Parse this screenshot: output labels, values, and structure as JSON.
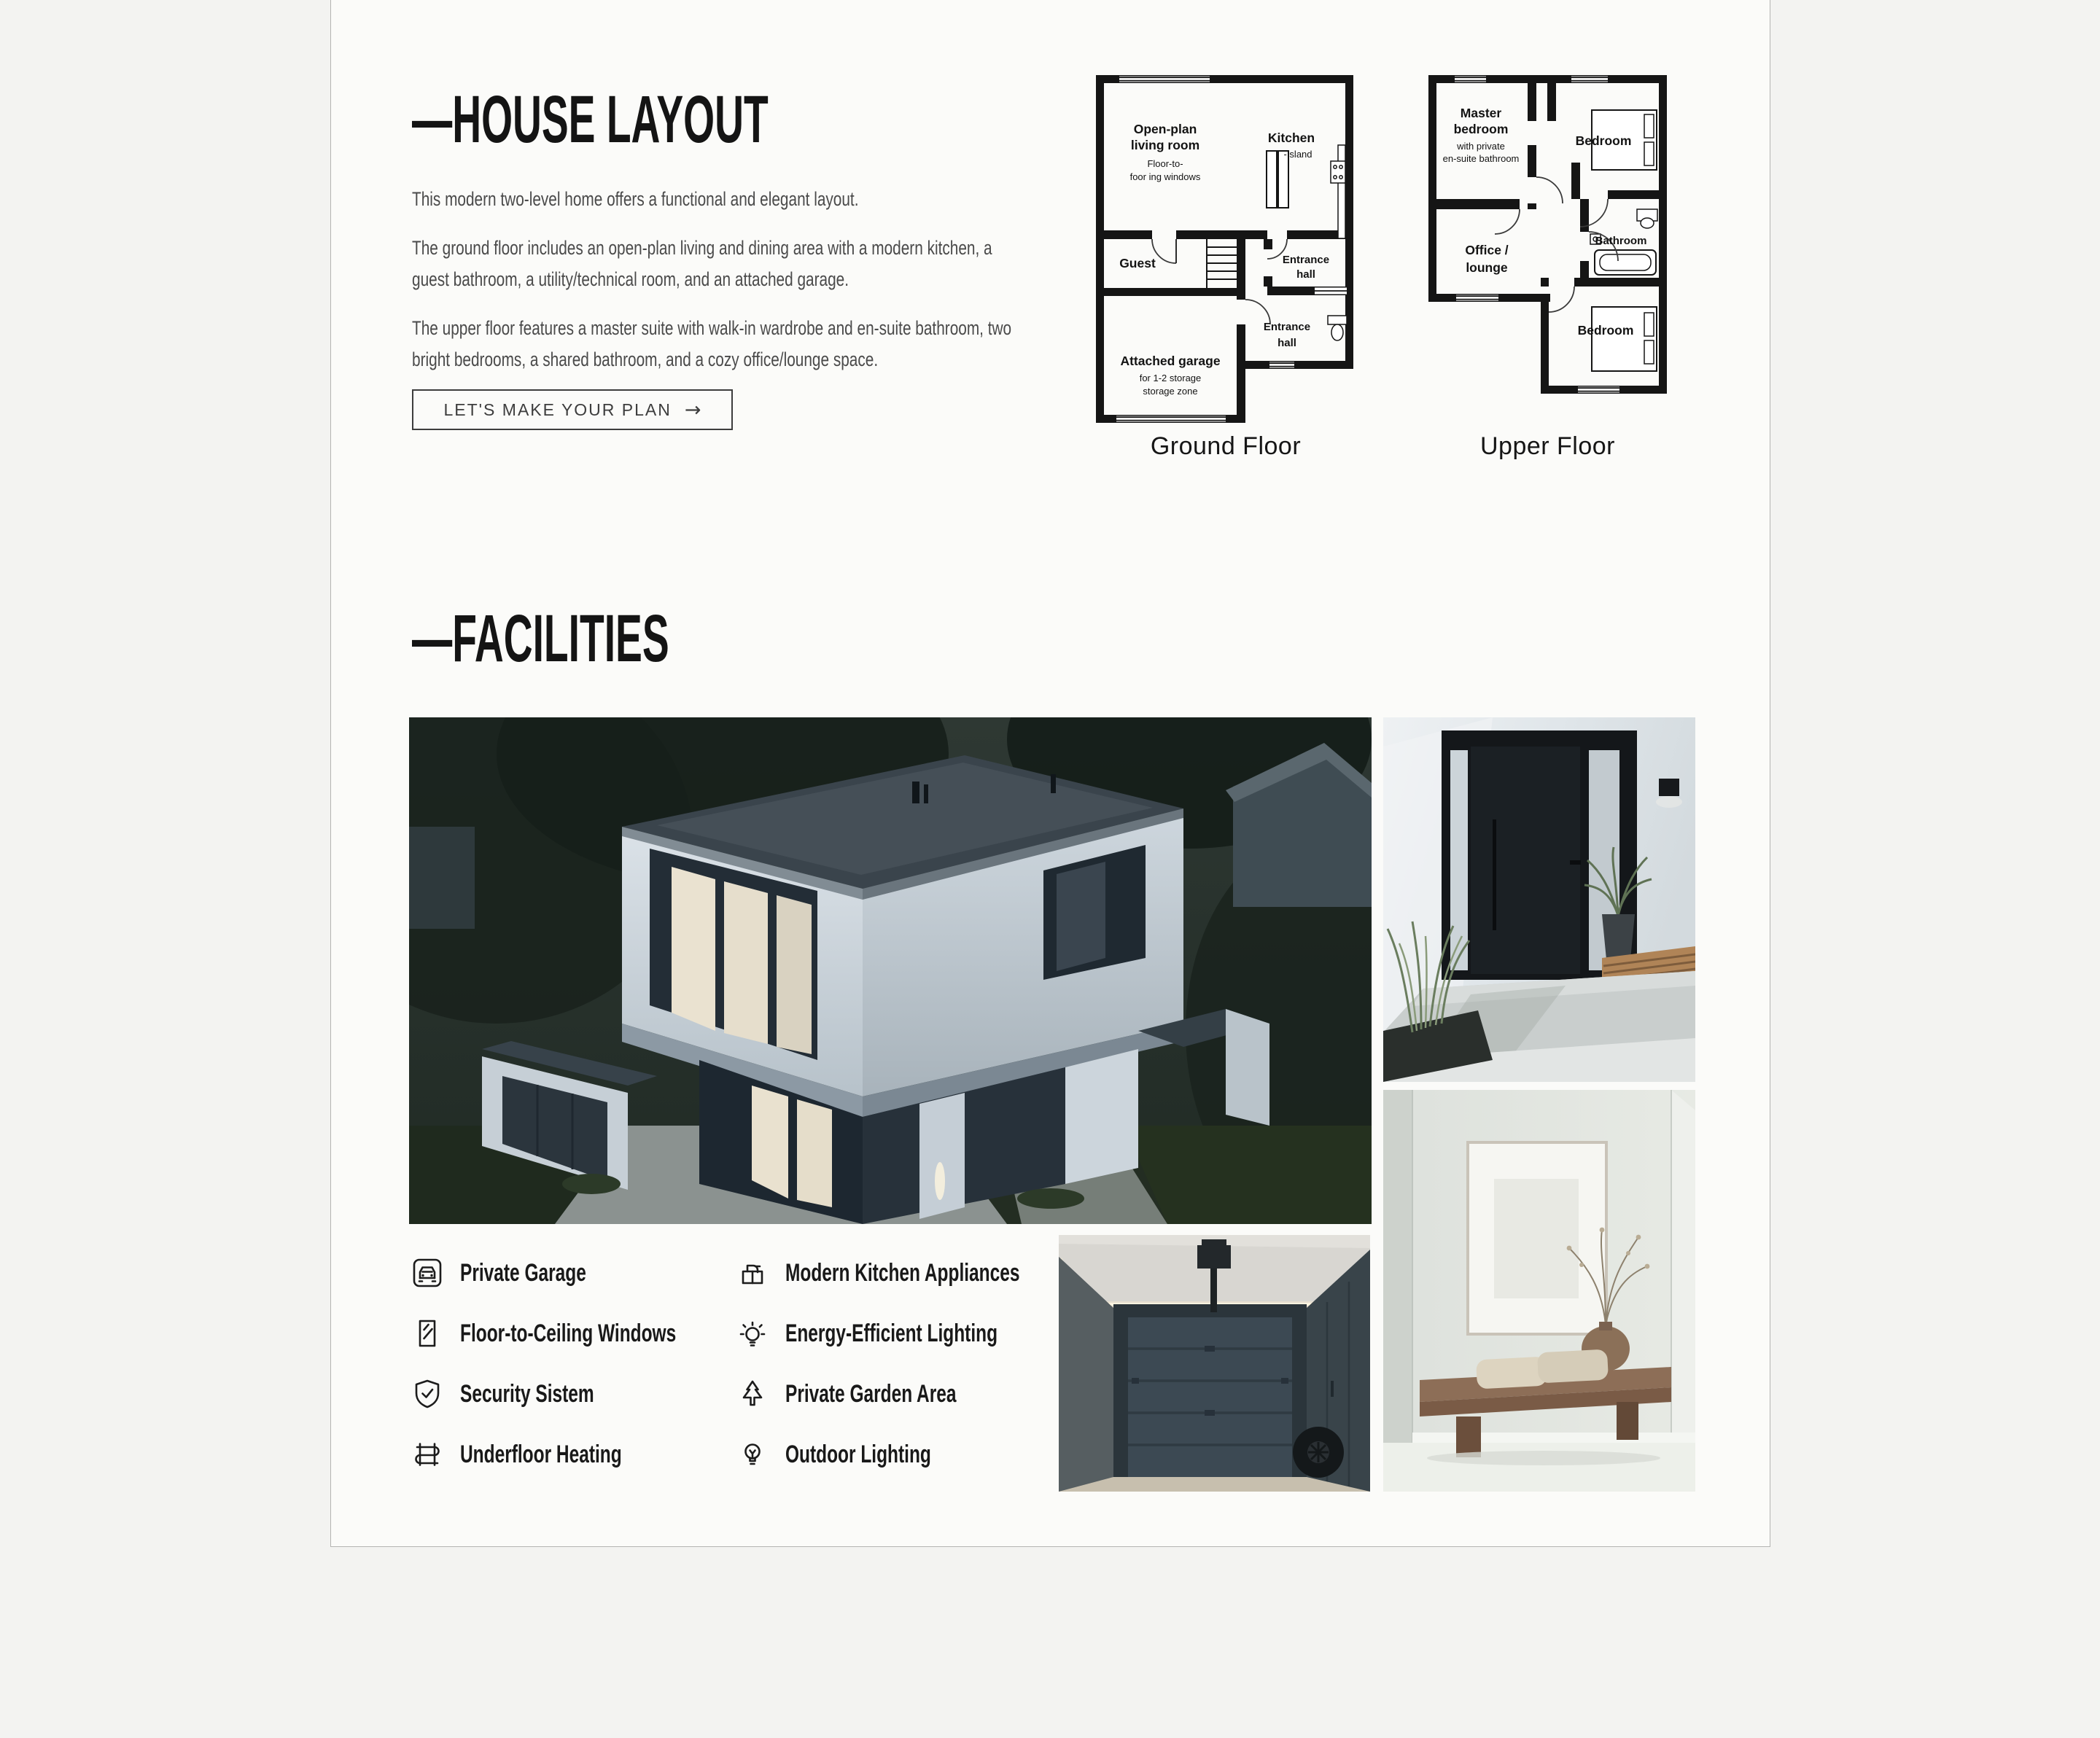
{
  "theme": {
    "page_bg": "#f3f3f1",
    "card_bg": "#fbfbf9",
    "card_border": "#b4b4b2",
    "heading_color": "#141414",
    "body_text_color": "#4a4a4a",
    "accent_dark": "#3d3d3d",
    "plan_ink": "#151515"
  },
  "layout_section": {
    "heading": "—HOUSE LAYOUT",
    "paragraphs": [
      "This modern two-level home offers a functional and elegant layout.",
      "The ground floor includes an open-plan living and dining area with a modern kitchen, a guest bathroom, a utility/technical room, and an attached garage.",
      "The upper floor features a master suite with walk-in wardrobe and en-suite bathroom, two bright bedrooms, a shared bathroom, and a cozy office/lounge space."
    ],
    "cta": {
      "label": "LET'S MAKE YOUR PLAN",
      "arrow": "→"
    }
  },
  "floor_plans": {
    "ground": {
      "caption": "Ground Floor",
      "living1": "Open-plan",
      "living2": "living room",
      "living3": "Floor-to-",
      "living4": "foor ing windows",
      "kitchen": "Kitchen",
      "island": "-Island",
      "guest": "Guest",
      "hallA1": "Entrance",
      "hallA2": "hall",
      "hallB1": "Entrance",
      "hallB2": "hall",
      "garage1": "Attached garage",
      "garage2": "for 1-2 storage",
      "garage3": "storage zone"
    },
    "upper": {
      "caption": "Upper Floor",
      "master1": "Master",
      "master2": "bedroom",
      "master3": "with private",
      "master4": "en-suite bathroom",
      "bedroom_top": "Bedroom",
      "office1": "Office /",
      "office2": "lounge",
      "bathroom": "Bathroom",
      "bedroom_bottom": "Bedroom"
    }
  },
  "facilities_section": {
    "heading": "—FACILITIES",
    "items": [
      {
        "icon": "garage-icon",
        "label": "Private Garage"
      },
      {
        "icon": "window-icon",
        "label": "Floor-to-Ceiling Windows"
      },
      {
        "icon": "shield-check-icon",
        "label": "Security Sistem"
      },
      {
        "icon": "heating-coil-icon",
        "label": "Underfloor Heating"
      },
      {
        "icon": "kitchen-appliance-icon",
        "label": "Modern Kitchen Appliances"
      },
      {
        "icon": "bulb-rays-icon",
        "label": "Energy-Efficient Lighting"
      },
      {
        "icon": "pine-tree-icon",
        "label": "Private Garden Area"
      },
      {
        "icon": "bulb-icon",
        "label": "Outdoor Lighting"
      }
    ]
  }
}
